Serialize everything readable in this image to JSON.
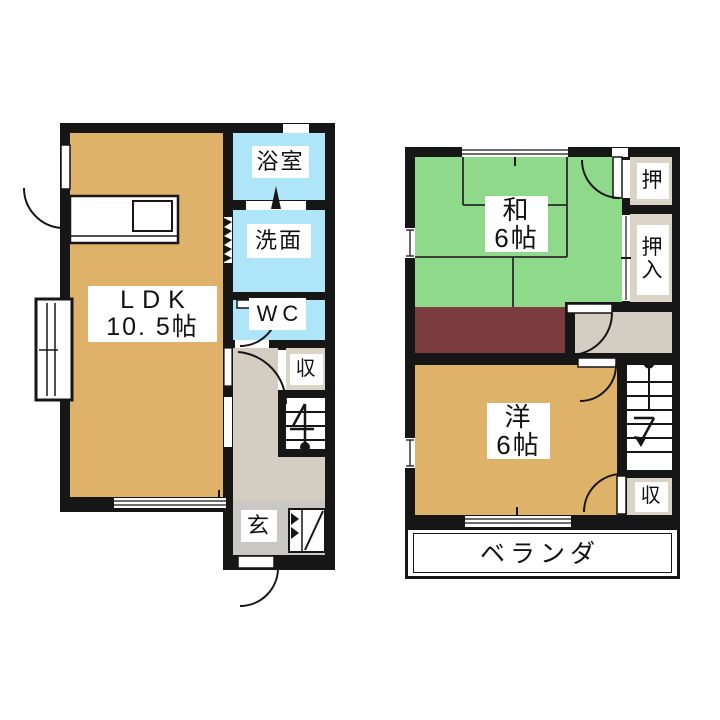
{
  "floor1": {
    "ldk_name": "LDK",
    "ldk_size": "10. 5帖",
    "bath": "浴室",
    "washroom": "洗面",
    "toilet": "WC",
    "storage": "収",
    "entrance": "玄"
  },
  "floor2": {
    "japanese_room_name": "和",
    "japanese_room_size": "6帖",
    "closet_upper": "押",
    "closet_main_top": "押",
    "closet_main_bottom": "入",
    "western_room_name": "洋",
    "western_room_size": "6帖",
    "storage": "収",
    "balcony": "ベランダ"
  },
  "colors": {
    "wall": "#161616",
    "room_tan": "#DFB269",
    "tatami_green": "#8FD98B",
    "water_blue": "#AFE5F8",
    "corridor_maroon": "#7B3C40",
    "hallway_gray": "#D3CEC1",
    "entrance_gray": "#C9C8C4",
    "closet_beige": "#D9D4C6"
  }
}
